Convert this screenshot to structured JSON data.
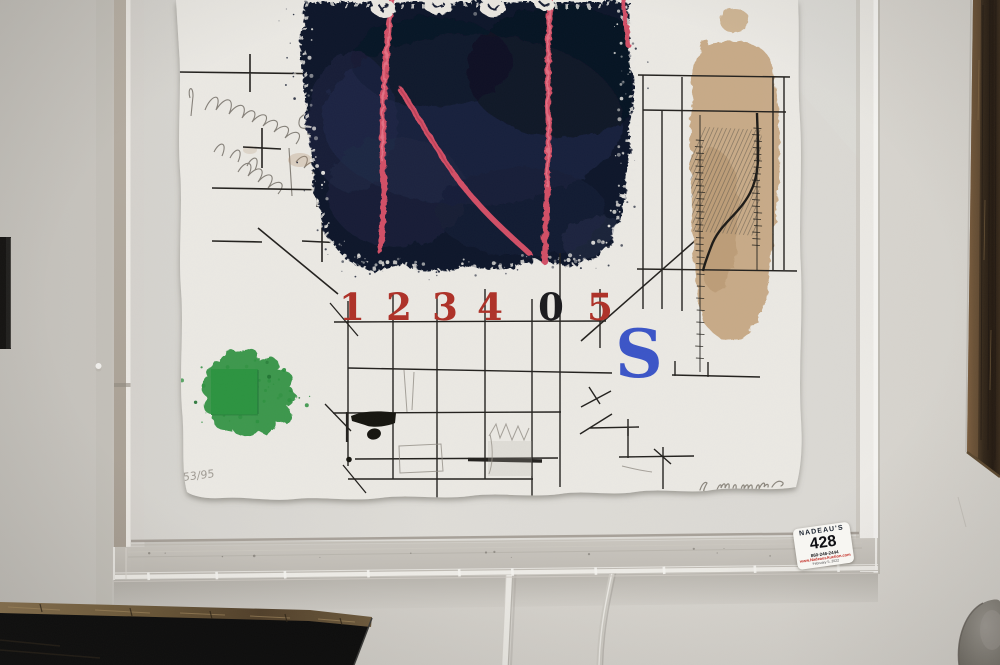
{
  "artwork": {
    "numbers": [
      "1",
      "2",
      "3",
      "4",
      "0",
      "5"
    ],
    "letter": "S",
    "edition": "53/95",
    "signature": "artist signature (illegible pencil)"
  },
  "sticker": {
    "house": "NADEAU'S",
    "lot": "428",
    "phone": "860-246-2444",
    "website": "www.NadeausAuction.com",
    "date_line": "February 5, 2022"
  },
  "colors": {
    "wall": "#cfccc6",
    "mat": "#dbd9d4",
    "paper": "#eae8e3",
    "navy_block": "#10172b",
    "red_lines": "#d14f66",
    "stencil_red": "#ae3128",
    "stencil_black": "#1b1b1e",
    "stencil_blue": "#3b55c7",
    "green": "#2e9040",
    "tan_collage": "#c4a47e",
    "ink": "#23211e"
  }
}
